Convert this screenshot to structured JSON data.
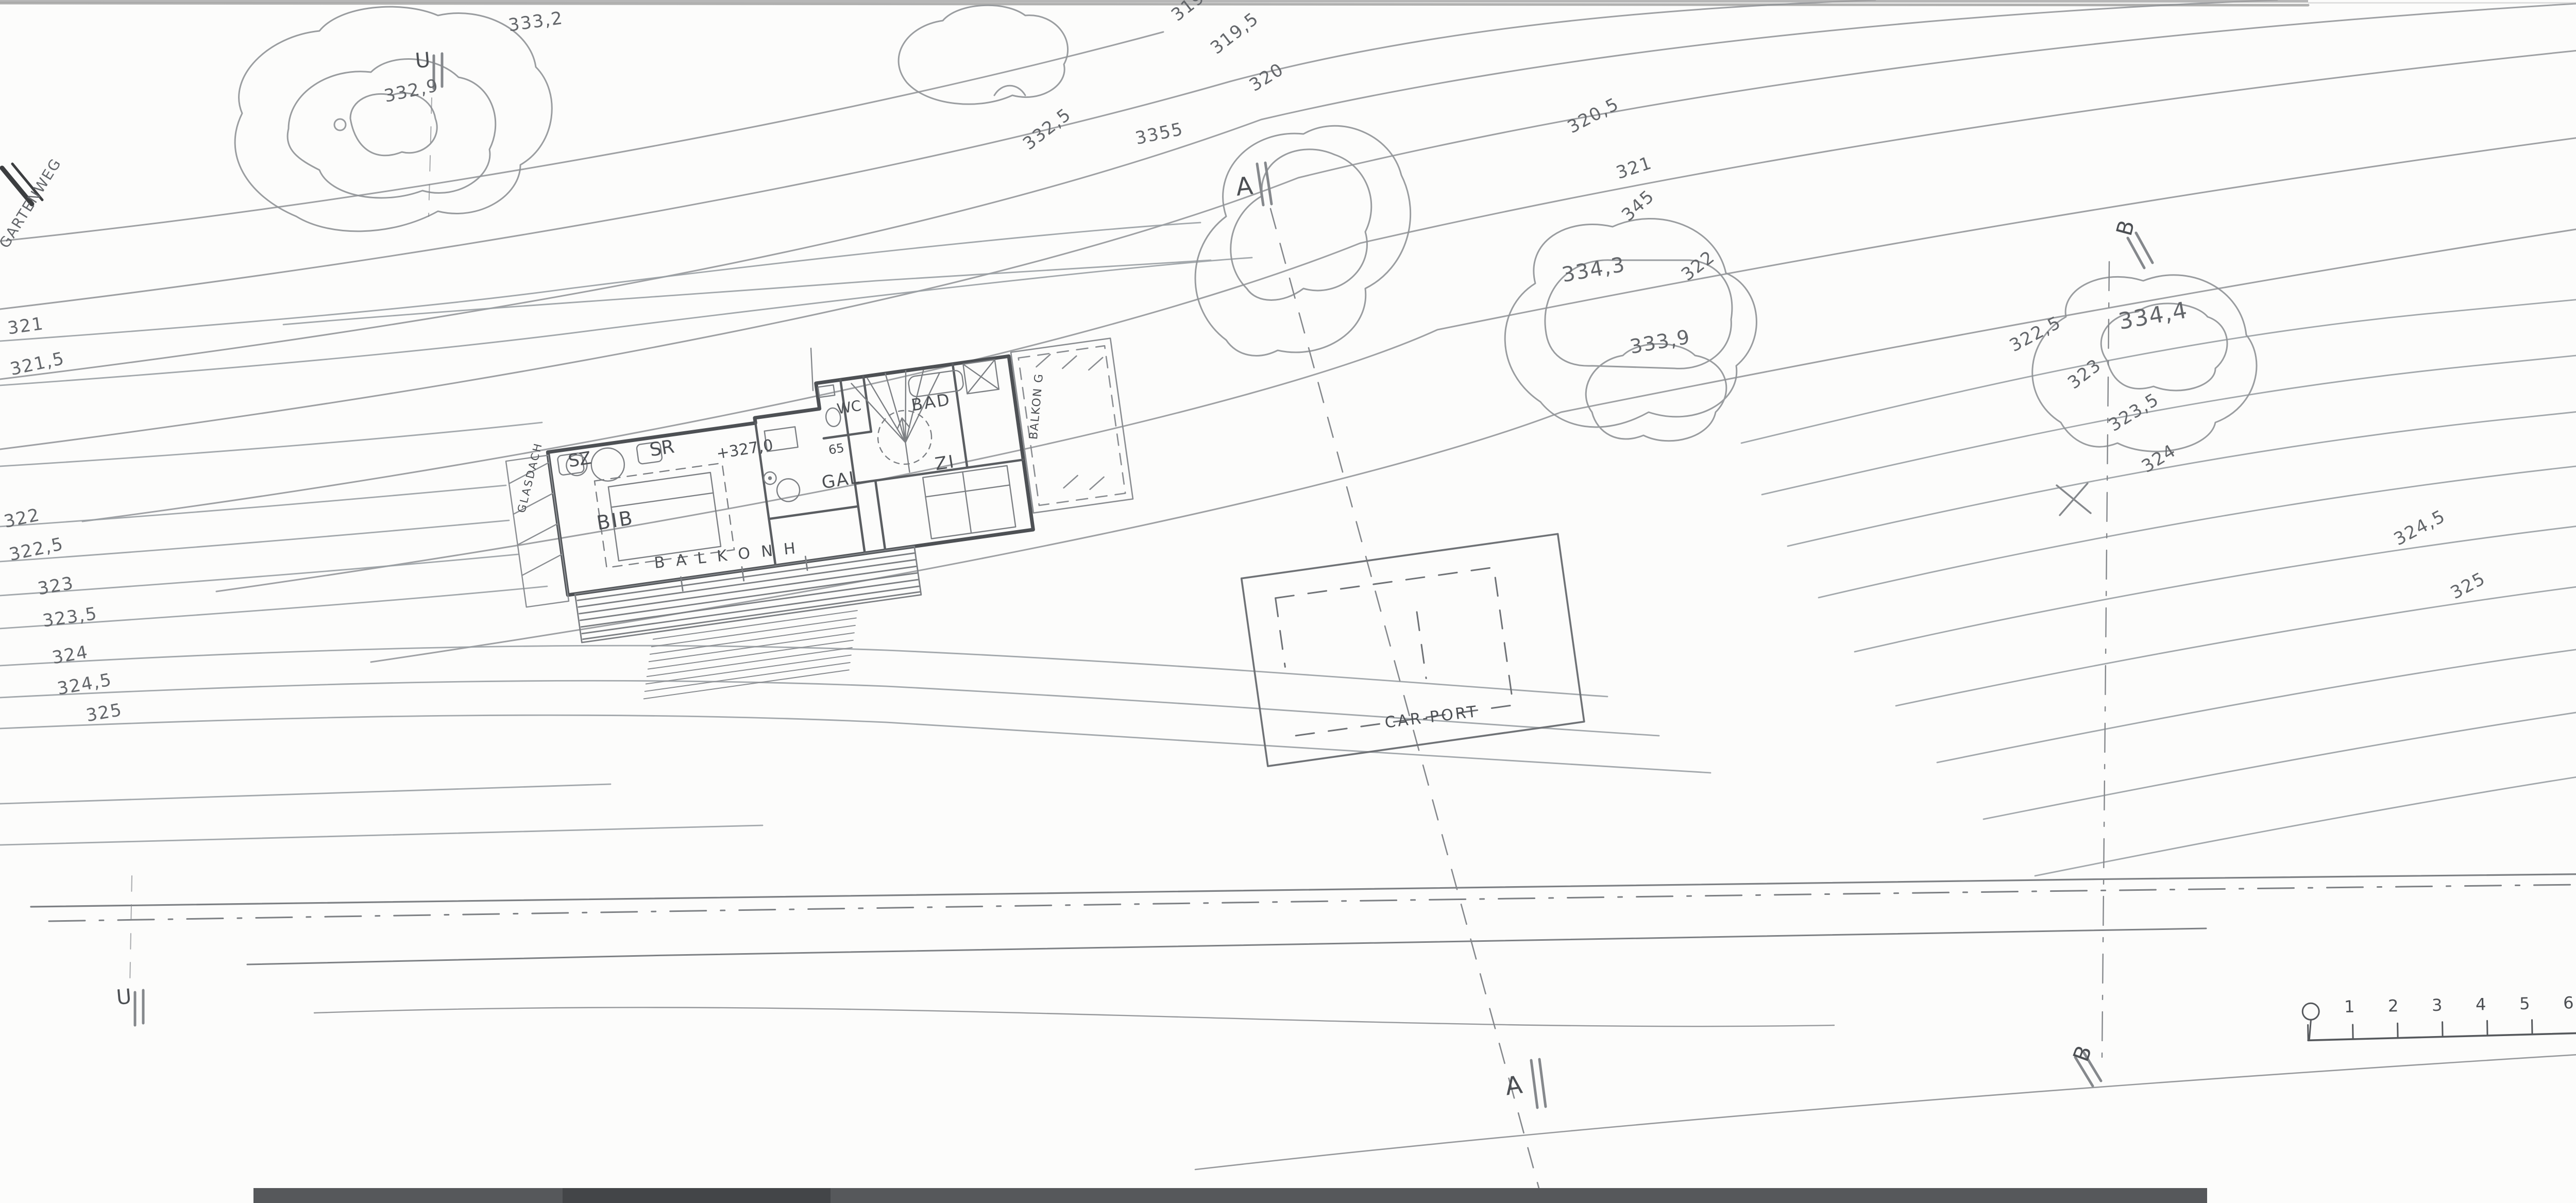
{
  "area_table": {
    "title_line1": "HAUS SCHRÖCK",
    "title_line2": "VORENTWURF VE03.1",
    "title_line3": "F L Ä C H E N · OG :",
    "rows": [
      {
        "label": "SZ",
        "value": ":  13,3 m²"
      },
      {
        "label": "SR",
        "value": ":  6,9 m²"
      },
      {
        "label": "WC",
        "value": ":  2,2 m²"
      },
      {
        "label": "BAD",
        "value": ":  9,0"
      },
      {
        "label": "TREP",
        "value": ":  5,1"
      },
      {
        "label": "Z1",
        "value": ":  14,3 m²"
      },
      {
        "label": "GAL",
        "value": ":  27,1 m²"
      },
      {
        "label": "BIB (ZI 2)",
        "value": ":  10,1 m²"
      }
    ],
    "sums": [
      {
        "label": "Σ NF OG",
        "value": ":  82,0 m²"
      },
      {
        "label": "Σ NF EG",
        "value": ":  84,0 m²"
      },
      {
        "label": "Σ NF OG+EG",
        "value": ":  166,0 m²"
      }
    ],
    "extras": [
      "(GLASDACH  32,2 m²)",
      "BALKON.H.:  14,7 m²",
      "BALKON.G   11,2 m²"
    ]
  },
  "title_block": {
    "drawing_title": "GRUNDRISS OG",
    "version": "VE03.1",
    "subtitle": "OBERGESCHOSS"
  },
  "revision_note": {
    "code": "HSC",
    "sup": "GR",
    "code2": "OG /E 1",
    "version": "VE03",
    "date": "4.5.2021",
    "scale": "MST 1:200"
  },
  "stamp": {
    "name": "MICHAEL LINGENHÖLE",
    "line2": "D I P L O M I N G E N I E U R",
    "line3": "STAATLICH BEFUGTER UND BEEIDETER ZIVILTECHNIKER",
    "line4": "A r c h i t e k t",
    "line5": "STEINGRABENWEG 28g   8044 GRAZ",
    "line6": "TEL + FAX : 0043-(0)316-33 80 34"
  },
  "plan": {
    "glasdach": "GLASDACH",
    "sz": "SZ",
    "sr": "SR",
    "wc": "WC",
    "bad": "BAD",
    "z1": "ZI",
    "gal": "GAL",
    "bib": "BIB",
    "balkon_h": "B A L K O N  H",
    "balkon_g": "BALKON G",
    "carport": "CAR-PORT",
    "level": "+327,0",
    "dim": "65"
  },
  "survey": {
    "p1_label": "∅P 1",
    "p1_elev": "327,0"
  },
  "markers": {
    "a": "A",
    "b": "B",
    "u": "U",
    "n": "N"
  },
  "scale_bar": {
    "labels": [
      "1",
      "2",
      "3",
      "4",
      "5",
      "6",
      "7",
      "8",
      "9",
      "10"
    ]
  },
  "contours": [
    "332,9",
    "333,2",
    "319",
    "319,5",
    "320",
    "332,5",
    "3355",
    "320,5",
    "321",
    "345",
    "334,3",
    "322",
    "333,9",
    "322,5",
    "323",
    "323,5",
    "324",
    "334,4",
    "324,5",
    "325",
    "325,5",
    "326",
    "321",
    "321,5",
    "322",
    "322,5",
    "323",
    "323,5",
    "324",
    "324,5",
    "325",
    "GARTENWEG"
  ]
}
